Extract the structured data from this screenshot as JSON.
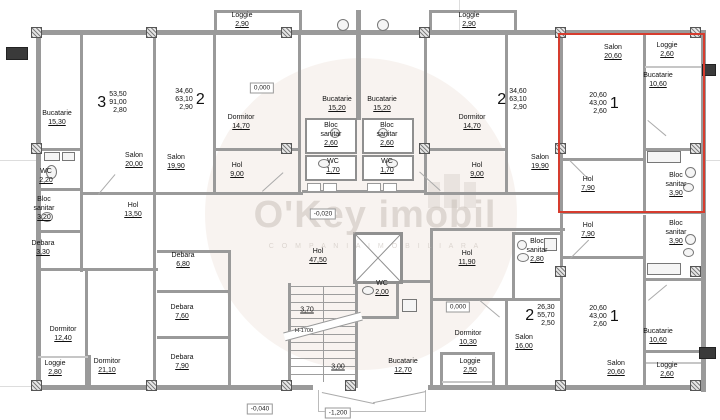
{
  "watermark": {
    "brand": "O'Key imobil",
    "tagline": "C O M P A N I A   I M O B I L I A R A"
  },
  "colors": {
    "highlight": "#d63c2e",
    "wall": "#9a9a9a",
    "text": "#111111",
    "watermark": "#c9c1ba"
  },
  "rooms": [
    {
      "n": "Loggie",
      "a": "2,90",
      "x": 242,
      "y": 12
    },
    {
      "n": "Loggie",
      "a": "2,90",
      "x": 469,
      "y": 12
    },
    {
      "n": "Bucatarie",
      "a": "15,30",
      "x": 57,
      "y": 110
    },
    {
      "n": "Salon",
      "a": "20,00",
      "x": 134,
      "y": 152
    },
    {
      "n": "Salon",
      "a": "19,90",
      "x": 176,
      "y": 154
    },
    {
      "n": "Dormitor",
      "a": "14,70",
      "x": 241,
      "y": 114
    },
    {
      "n": "Hol",
      "a": "9,00",
      "x": 237,
      "y": 162
    },
    {
      "n": "Bucatarie",
      "a": "15,20",
      "x": 337,
      "y": 96
    },
    {
      "n": "Bucatarie",
      "a": "15,20",
      "x": 382,
      "y": 96
    },
    {
      "n": "Bloc sanitar",
      "a": "2,60",
      "x": 331,
      "y": 122
    },
    {
      "n": "Bloc sanitar",
      "a": "2,60",
      "x": 387,
      "y": 122
    },
    {
      "n": "WC",
      "a": "1,70",
      "x": 333,
      "y": 158
    },
    {
      "n": "WC",
      "a": "1,70",
      "x": 387,
      "y": 158
    },
    {
      "n": "Dormitor",
      "a": "14,70",
      "x": 472,
      "y": 114
    },
    {
      "n": "Hol",
      "a": "9,00",
      "x": 477,
      "y": 162
    },
    {
      "n": "Salon",
      "a": "19,90",
      "x": 540,
      "y": 154
    },
    {
      "n": "Salon",
      "a": "20,60",
      "x": 613,
      "y": 44
    },
    {
      "n": "Loggie",
      "a": "2,60",
      "x": 667,
      "y": 42
    },
    {
      "n": "Bucatarie",
      "a": "10,60",
      "x": 658,
      "y": 72
    },
    {
      "n": "Hol",
      "a": "7,90",
      "x": 588,
      "y": 176
    },
    {
      "n": "Bloc sanitar",
      "a": "3,90",
      "x": 676,
      "y": 172
    },
    {
      "n": "WC",
      "a": "2,20",
      "x": 46,
      "y": 168
    },
    {
      "n": "Bloc sanitar",
      "a": "3,20",
      "x": 44,
      "y": 196
    },
    {
      "n": "Debara",
      "a": "3,30",
      "x": 43,
      "y": 240
    },
    {
      "n": "Hol",
      "a": "13,50",
      "x": 133,
      "y": 202
    },
    {
      "n": "Debara",
      "a": "6,80",
      "x": 183,
      "y": 252
    },
    {
      "n": "Debara",
      "a": "7,60",
      "x": 182,
      "y": 304
    },
    {
      "n": "Debara",
      "a": "7,90",
      "x": 182,
      "y": 354
    },
    {
      "n": "Dormitor",
      "a": "12,40",
      "x": 63,
      "y": 326
    },
    {
      "n": "Loggie",
      "a": "2,80",
      "x": 55,
      "y": 360
    },
    {
      "n": "Dormitor",
      "a": "21,10",
      "x": 107,
      "y": 358
    },
    {
      "n": "Hol",
      "a": "47,50",
      "x": 318,
      "y": 248
    },
    {
      "n": "WC",
      "a": "2,00",
      "x": 382,
      "y": 280
    },
    {
      "n": "Bucatarie",
      "a": "12,70",
      "x": 403,
      "y": 358
    },
    {
      "n": "Hol",
      "a": "11,90",
      "x": 467,
      "y": 250
    },
    {
      "n": "Bloc sanitar",
      "a": "2,80",
      "x": 537,
      "y": 238
    },
    {
      "n": "Hol",
      "a": "7,90",
      "x": 588,
      "y": 222
    },
    {
      "n": "Bloc sanitar",
      "a": "3,90",
      "x": 676,
      "y": 220
    },
    {
      "n": "Dormitor",
      "a": "10,30",
      "x": 468,
      "y": 330
    },
    {
      "n": "Loggie",
      "a": "2,50",
      "x": 470,
      "y": 358
    },
    {
      "n": "Salon",
      "a": "16,00",
      "x": 524,
      "y": 334
    },
    {
      "n": "Salon",
      "a": "20,60",
      "x": 616,
      "y": 360
    },
    {
      "n": "Bucatarie",
      "a": "10,60",
      "x": 658,
      "y": 328
    },
    {
      "n": "Loggie",
      "a": "2,60",
      "x": 667,
      "y": 362
    }
  ],
  "apartments": [
    {
      "digit": "3",
      "areas": [
        "53,50",
        "91,00",
        "2,80"
      ],
      "side": "L",
      "x": 112,
      "y": 103
    },
    {
      "digit": "2",
      "areas": [
        "34,60",
        "63,10",
        "2,90"
      ],
      "side": "R",
      "x": 190,
      "y": 100
    },
    {
      "digit": "2",
      "areas": [
        "34,60",
        "63,10",
        "2,90"
      ],
      "side": "L",
      "x": 512,
      "y": 100
    },
    {
      "digit": "1",
      "areas": [
        "20,60",
        "43,00",
        "2,60"
      ],
      "side": "R",
      "x": 604,
      "y": 104
    },
    {
      "digit": "2",
      "areas": [
        "26,30",
        "55,70",
        "2,50"
      ],
      "side": "L",
      "x": 540,
      "y": 316
    },
    {
      "digit": "1",
      "areas": [
        "20,60",
        "43,00",
        "2,60"
      ],
      "side": "R",
      "x": 604,
      "y": 317
    }
  ],
  "levels": [
    {
      "v": "0,000",
      "x": 262,
      "y": 88
    },
    {
      "v": "-0,020",
      "x": 323,
      "y": 214
    },
    {
      "v": "0,000",
      "x": 458,
      "y": 307
    },
    {
      "v": "-0,040",
      "x": 260,
      "y": 409
    },
    {
      "v": "-1,200",
      "x": 338,
      "y": 413
    }
  ],
  "dims": [
    {
      "v": "3,70",
      "x": 307,
      "y": 310,
      "u": true,
      "s": false
    },
    {
      "v": "H-1700",
      "x": 304,
      "y": 331,
      "u": false,
      "s": true
    },
    {
      "v": "3,00",
      "x": 338,
      "y": 367,
      "u": true,
      "s": false
    }
  ]
}
